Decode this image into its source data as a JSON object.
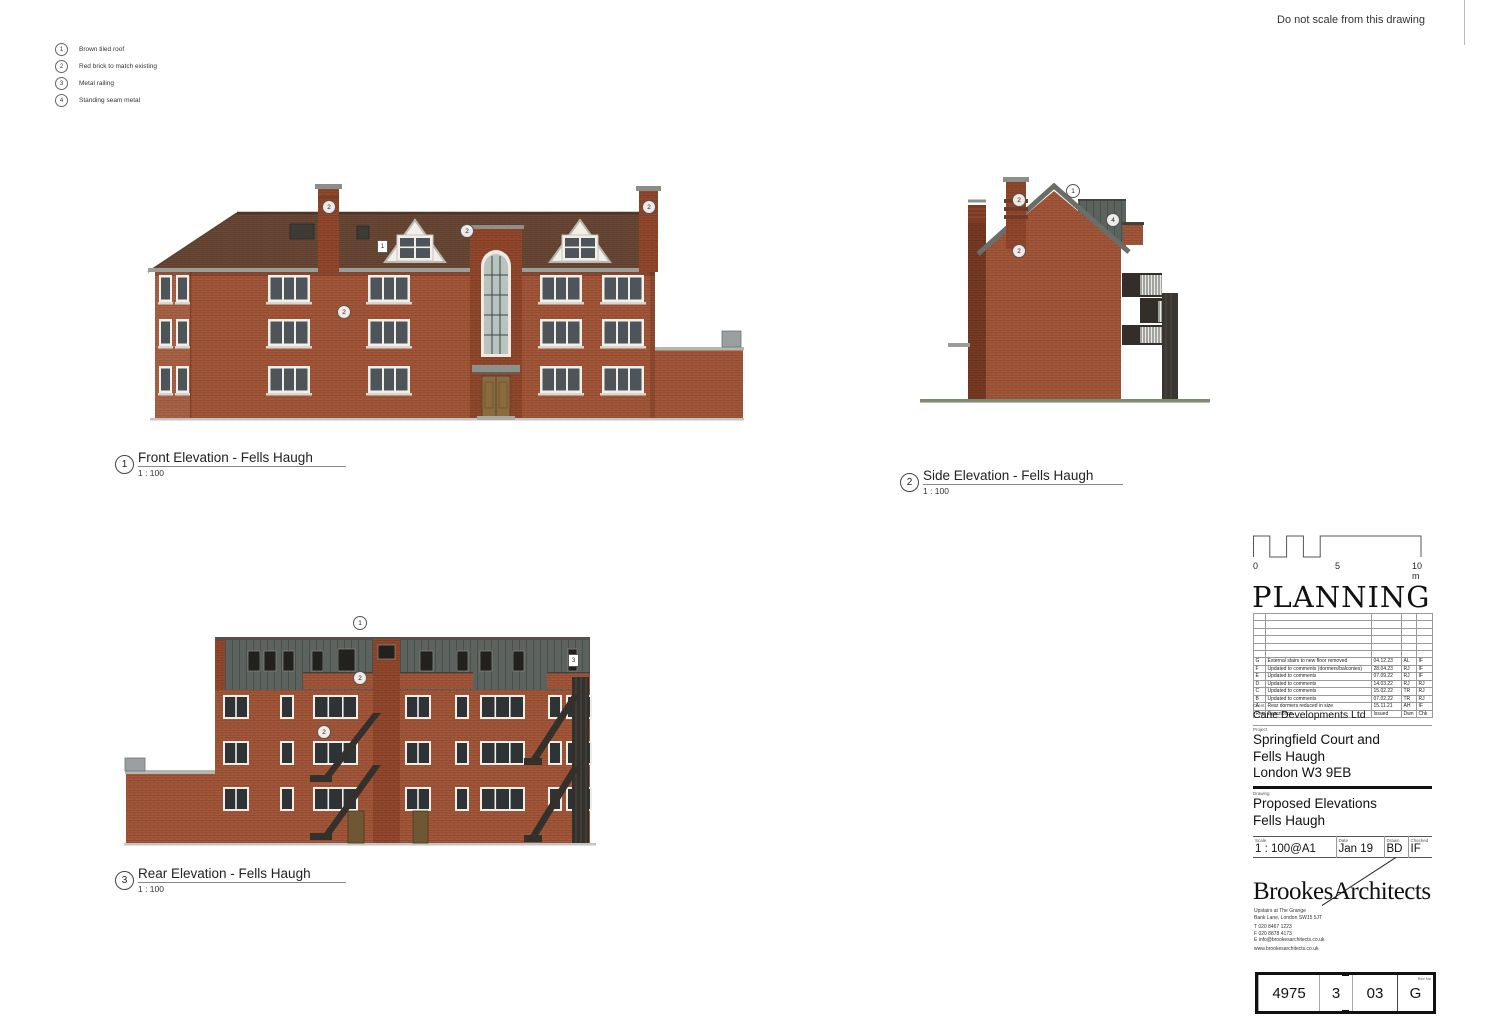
{
  "sheet": {
    "note": "Do not scale from this drawing"
  },
  "colors": {
    "brick": "#a3583a",
    "brick_dark": "#94492c",
    "roof_tile": "#6b4936",
    "standing_seam": "#5c625d",
    "railing": "#e9e9e6",
    "ground": "#c4c4c4",
    "side_ground": "#7d8a72"
  },
  "legend": {
    "items": [
      {
        "num": "1",
        "text": "Brown tiled roof"
      },
      {
        "num": "2",
        "text": "Red brick to match existing"
      },
      {
        "num": "3",
        "text": "Metal railing"
      },
      {
        "num": "4",
        "text": "Standing seam metal"
      }
    ]
  },
  "elevations": {
    "front": {
      "num": "1",
      "title": "Front Elevation - Fells Haugh",
      "scale": "1 : 100",
      "callouts": [
        "2",
        "2",
        "2",
        "2"
      ],
      "tags": [
        "1"
      ]
    },
    "side": {
      "num": "2",
      "title": "Side Elevation - Fells Haugh",
      "scale": "1 : 100",
      "callouts": [
        "1",
        "2",
        "2",
        "4"
      ]
    },
    "rear": {
      "num": "3",
      "title": "Rear Elevation - Fells Haugh",
      "scale": "1 : 100",
      "callouts": [
        "1",
        "2",
        "2"
      ],
      "tags": [
        "3"
      ]
    }
  },
  "scale_bar": {
    "zero": "0",
    "five": "5",
    "ten": "10 m"
  },
  "titleblock": {
    "stage": "PLANNING",
    "revisions": {
      "headers": {
        "rev": "Rev",
        "description": "Description",
        "issued": "Issued",
        "dwn": "Dwn",
        "chk": "Chk"
      },
      "rows": [
        {
          "rev": "",
          "description": "",
          "issued": "",
          "dwn": "",
          "chk": ""
        },
        {
          "rev": "",
          "description": "",
          "issued": "",
          "dwn": "",
          "chk": ""
        },
        {
          "rev": "",
          "description": "",
          "issued": "",
          "dwn": "",
          "chk": ""
        },
        {
          "rev": "",
          "description": "",
          "issued": "",
          "dwn": "",
          "chk": ""
        },
        {
          "rev": "",
          "description": "",
          "issued": "",
          "dwn": "",
          "chk": ""
        },
        {
          "rev": "",
          "description": "",
          "issued": "",
          "dwn": "",
          "chk": ""
        },
        {
          "rev": "G",
          "description": "External stairs to new floor removed",
          "issued": "04.12.23",
          "dwn": "AL",
          "chk": "IF"
        },
        {
          "rev": "F",
          "description": "Updated to comments (dormers/balconies)",
          "issued": "28.04.23",
          "dwn": "RJ",
          "chk": "IF"
        },
        {
          "rev": "E",
          "description": "Updated to comments",
          "issued": "07.09.22",
          "dwn": "RJ",
          "chk": "IF"
        },
        {
          "rev": "D",
          "description": "Updated to comments",
          "issued": "14.03.22",
          "dwn": "RJ",
          "chk": "RJ"
        },
        {
          "rev": "C",
          "description": "Updated to comments",
          "issued": "15.02.22",
          "dwn": "TR",
          "chk": "RJ"
        },
        {
          "rev": "B",
          "description": "Updated to comments",
          "issued": "07.02.22",
          "dwn": "TR",
          "chk": "RJ"
        },
        {
          "rev": "A",
          "description": "Rear dormers reduced in size",
          "issued": "15.11.21",
          "dwn": "AH",
          "chk": "IF"
        }
      ]
    },
    "client": {
      "label": "Client",
      "name": "Cane Developments Ltd"
    },
    "project": {
      "label": "Project",
      "lines": [
        "Springfield Court and",
        "Fells Haugh",
        "London W3 9EB"
      ]
    },
    "drawing": {
      "label": "Drawing",
      "lines": [
        "Proposed Elevations",
        "Fells Haugh"
      ]
    },
    "info": {
      "scale_label": "Scale",
      "scale": "1 : 100@A1",
      "date_label": "Date",
      "date": "Jan 19",
      "drawn_label": "Drawn",
      "drawn": "BD",
      "checked_label": "Checked",
      "checked": "IF"
    },
    "firm": {
      "logo": "BrookesArchitects",
      "address": [
        "Upstairs at The Grange",
        "Bank Lane, London SW15 5JT"
      ],
      "contacts": [
        "T 020 8467 1223",
        "F 020 8878 4173",
        "E info@brookesarchitects.co.uk"
      ],
      "website": "www.brookesarchitects.co.uk"
    },
    "number": {
      "project": "4975",
      "originator": "3",
      "sheet": "03",
      "rev_label": "Rev No",
      "rev": "G"
    }
  }
}
